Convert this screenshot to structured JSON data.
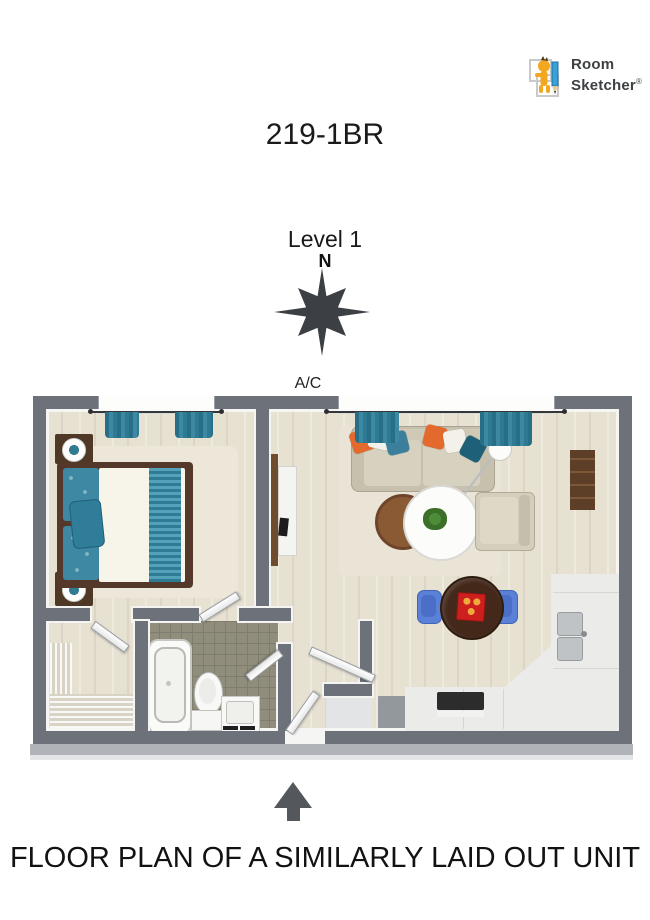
{
  "logo": {
    "line1": "Room",
    "line2": "Sketcher",
    "registered": "®"
  },
  "plan_header": {
    "unit_title": "219-1BR",
    "level_label": "Level 1",
    "north_letter": "N"
  },
  "plan_labels": {
    "ac": "A/C"
  },
  "caption": {
    "text": "FLOOR PLAN OF A SIMILARLY LAID OUT UNIT"
  },
  "colors": {
    "wall": "#6c717a",
    "floor_wood": "#e7e1d2",
    "bathroom_tile": "#908d7c",
    "teal_accent": "#2f7c94",
    "orange_accent": "#e4692c",
    "sofa_beige": "#c7c0ad",
    "rug_beige": "#e9e4d5",
    "bed_frame_brown": "#54392a",
    "duvet_white": "#f7f4ea",
    "dining_table_brown": "#44291b",
    "chair_blue": "#5a80d8",
    "tray_red": "#ce1f1f",
    "counter_white": "#ebecea",
    "compass_gray": "#3c4044",
    "arrow_gray": "#54585d",
    "logo_yellow": "#f3a71e",
    "logo_pencil_blue": "#3aa0d8"
  },
  "icons": {
    "logo_mark": "roomsketcher-figure-with-pencil",
    "compass": "compass-rose",
    "entrance": "entrance-arrow"
  }
}
